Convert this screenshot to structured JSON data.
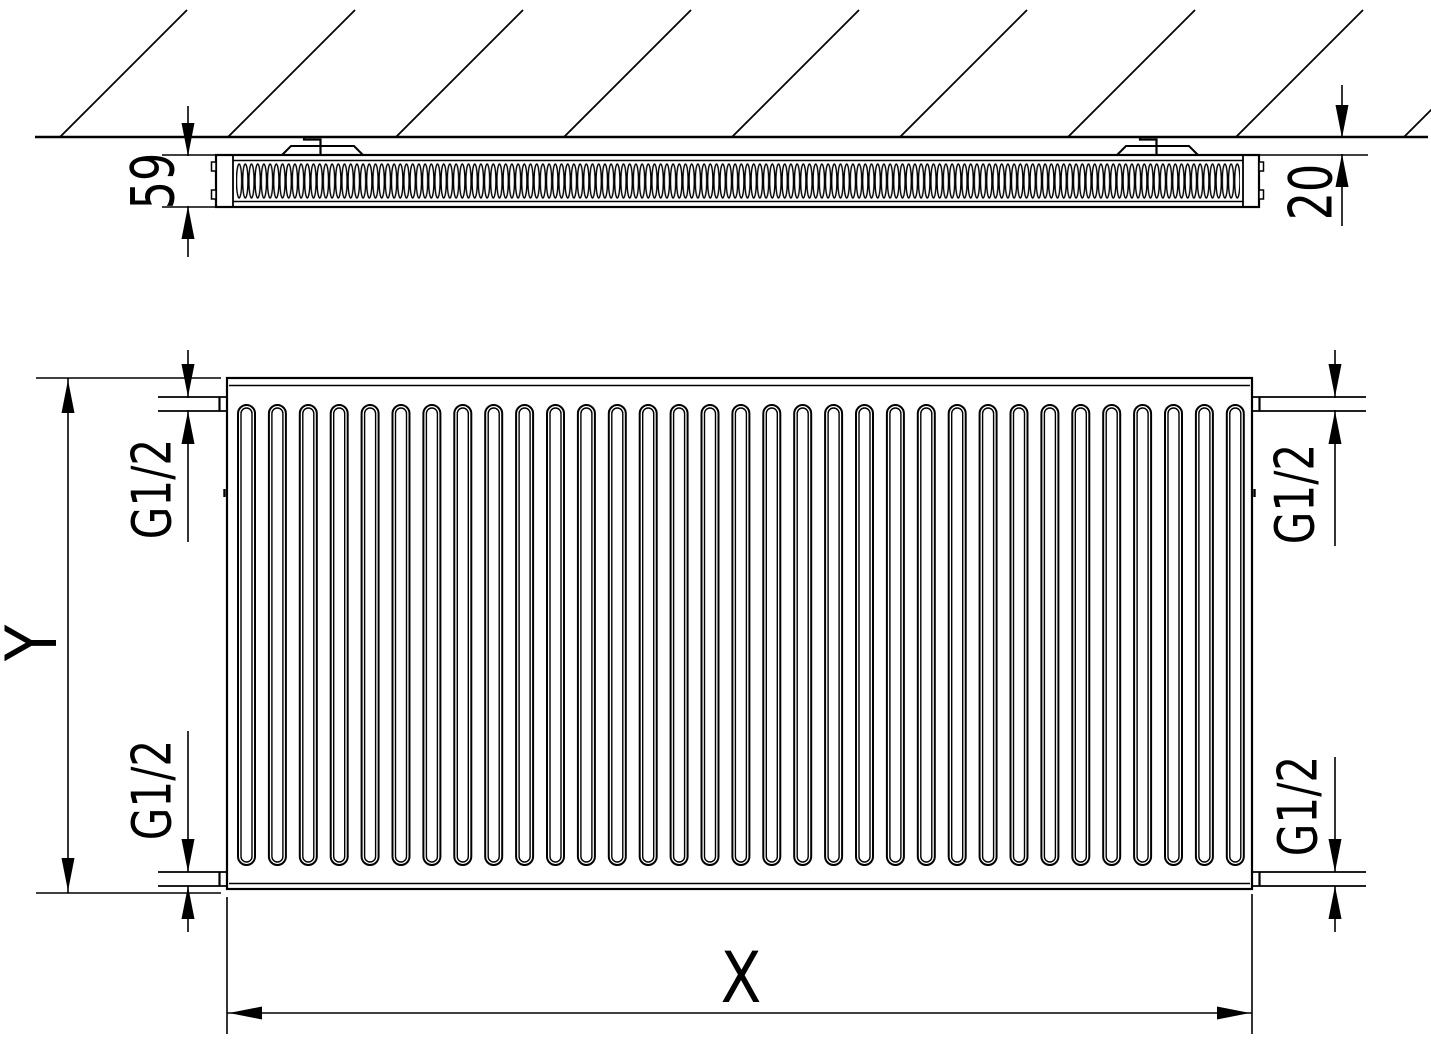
{
  "colors": {
    "line": "#000000",
    "background": "#ffffff"
  },
  "top_view": {
    "depth_label": "59",
    "wall_gap_label": "20"
  },
  "front_view": {
    "height_label": "Y",
    "width_label": "X",
    "connections": {
      "top_left": "G1/2",
      "bottom_left": "G1/2",
      "top_right": "G1/2",
      "bottom_right": "G1/2"
    }
  }
}
